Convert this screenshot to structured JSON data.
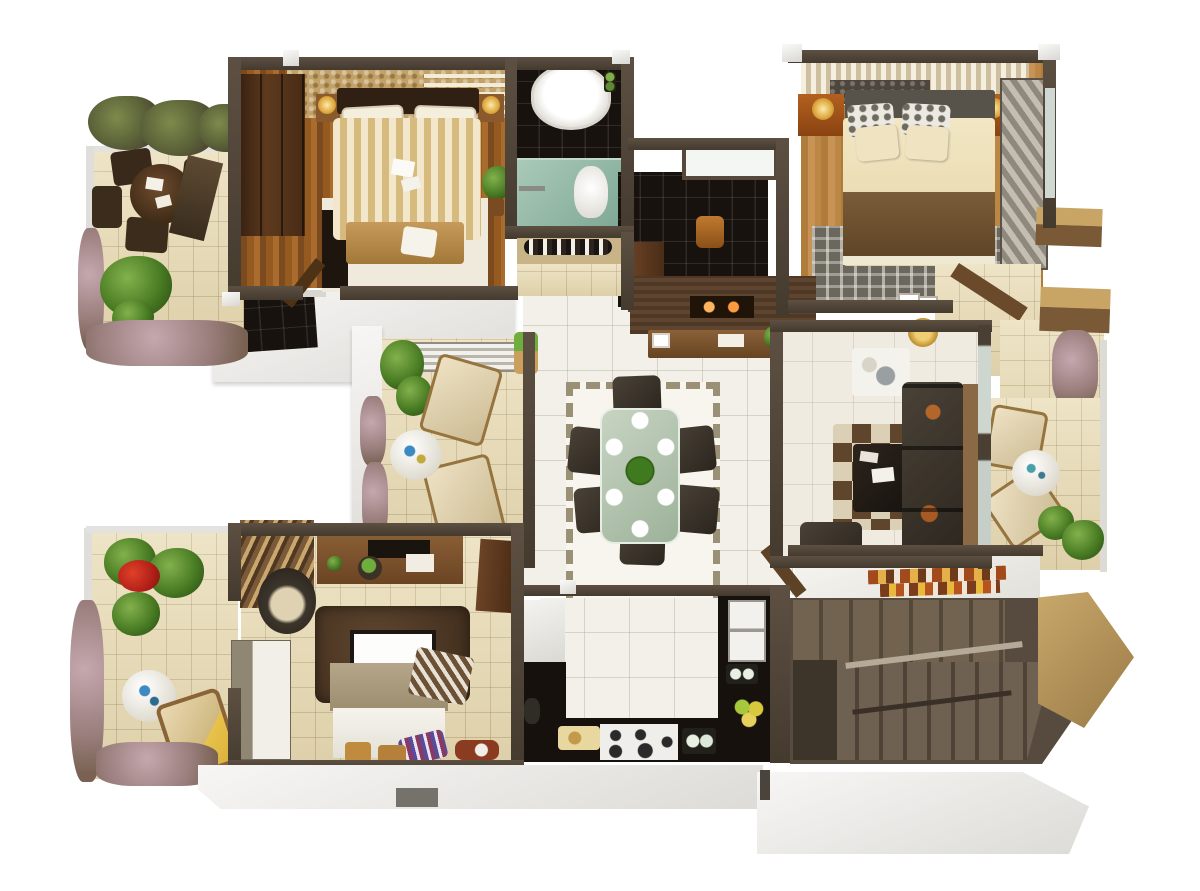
{
  "scene": {
    "title": "3D isometric floor plan of a three-bedroom apartment, top-down render on white background",
    "background_color": "#ffffff"
  },
  "palette": {
    "wall_dark": "#4a3f33",
    "wall_white": "#ececea",
    "floor_marble": "#f2f0e9",
    "floor_wood_dark": "#955a20",
    "floor_wood_light": "#c89354",
    "floor_tile_beige": "#e9dcb6",
    "tile_black": "#17120d",
    "shower_teal": "#9ec2b2",
    "sofa_dark": "#37302a",
    "bed_cream": "#ecd9a6",
    "blanket_brown": "#6f5433",
    "rug_shag_brown": "#523c29",
    "counter_black": "#16110d",
    "stair_brown": "#5e5244",
    "plant_green": "#4a7c24",
    "flower_red": "#c32a22",
    "nightstand_orange": "#a65a1e",
    "lamp_gold": "#ddb158"
  },
  "rooms": [
    {
      "id": "balcony-top-left",
      "label": "Pergola balcony — outdoor dining",
      "items": [
        "pergola vines",
        "round wood table",
        "papers on table",
        "dark chairs",
        "privacy screen panel",
        "flower borders",
        "palm plants",
        "tile floor"
      ]
    },
    {
      "id": "bedroom-1",
      "label": "Bedroom 1",
      "items": [
        "gold textured headboard wall",
        "dark wardrobe",
        "double bed with cream patterned duvet",
        "white pillows",
        "two nightstands with lamps",
        "foot bench with cushion",
        "white rug",
        "media cabinet",
        "potted plant",
        "door leaf"
      ]
    },
    {
      "id": "bathroom-1",
      "label": "Bathroom 1",
      "items": [
        "white oval bathtub",
        "black tile floor",
        "teal shower zone",
        "white toilet",
        "toiletry bottles"
      ]
    },
    {
      "id": "foyer-passage",
      "label": "Foyer / passage",
      "items": [
        "skylight panel",
        "dark tile floor",
        "wooden stool",
        "brown door panel"
      ]
    },
    {
      "id": "master-bedroom",
      "label": "Master bedroom",
      "items": [
        "striped headboard wall",
        "grey headboard",
        "patterned pillows",
        "cream pillows",
        "cream bed",
        "brown blanket",
        "patterned grey rug",
        "orange nightstands with gold lamps",
        "textured sliding wardrobe",
        "window"
      ]
    },
    {
      "id": "dressing-area",
      "label": "Dressing area",
      "items": [
        "beige tile floor",
        "angled brown door"
      ]
    },
    {
      "id": "master-balcony",
      "label": "Master balcony",
      "items": [
        "tan privacy wall blocks",
        "hanging vines",
        "beige tile floor"
      ]
    },
    {
      "id": "dining-area",
      "label": "Dining area",
      "items": [
        "glass dining table",
        "six dark chairs",
        "six white place settings",
        "green centerpiece",
        "bordered white rug",
        "marble floor"
      ]
    },
    {
      "id": "tv-console-wall",
      "label": "TV console wall",
      "items": [
        "dark wood accent wall",
        "fireplace niche",
        "wood sideboard",
        "white tray",
        "photo frames",
        "plant"
      ]
    },
    {
      "id": "living-room",
      "label": "Living room",
      "items": [
        "dark three-seat sofa",
        "decor plates on sofa",
        "checkered rug",
        "dark coffee table",
        "books",
        "floor lamp",
        "white side table",
        "photo frames",
        "armchair",
        "wood ledge"
      ]
    },
    {
      "id": "living-balcony",
      "label": "Living room balcony",
      "items": [
        "two beige chairs",
        "white round table",
        "potted plants",
        "hanging vines",
        "white railing"
      ]
    },
    {
      "id": "sitout-balcony",
      "label": "Sit-out balcony",
      "items": [
        "slatted bench",
        "two cream armchairs",
        "white round table",
        "potted plants",
        "hanging planter",
        "vine border"
      ]
    },
    {
      "id": "garden-balcony",
      "label": "Garden balcony",
      "items": [
        "palm plants",
        "red flowers",
        "vine border",
        "white round side table",
        "cream lounge chair",
        "flower bed"
      ]
    },
    {
      "id": "bedroom-2",
      "label": "Bedroom 2",
      "items": [
        "wood media wall with TV unit",
        "round planter",
        "striped curtain",
        "egg chair",
        "brown shag rug",
        "flat TV screen",
        "bed with white duvet",
        "tan blanket",
        "striped throw",
        "purple striped pillow",
        "two stools",
        "tall wardrobe",
        "brown door panel",
        "pet basket"
      ]
    },
    {
      "id": "kitchen",
      "label": "Kitchen",
      "items": [
        "U-shaped black counter",
        "four-burner cooktop",
        "double sink",
        "cutting board with bread",
        "glasses",
        "colorful plates",
        "white cabinet",
        "kettle"
      ]
    },
    {
      "id": "staircase",
      "label": "Staircase hall",
      "items": [
        "mosaic wall art",
        "upper stair flight",
        "lower stair flight",
        "handrail loop",
        "tan angled wall",
        "entry door leaf"
      ]
    }
  ]
}
